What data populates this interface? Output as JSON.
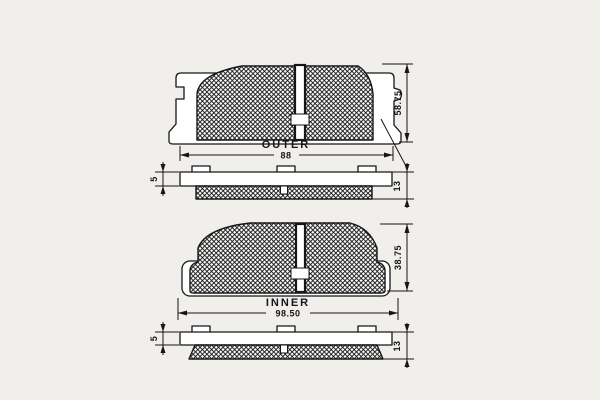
{
  "colors": {
    "paper": "#f1efec",
    "line": "#161616"
  },
  "outer_view": {
    "label": "OUTER",
    "width_dim": "88",
    "height_dim": "58.75"
  },
  "outer_profile": {
    "backplate_dim": "5",
    "thickness_dim": "13"
  },
  "inner_view": {
    "label": "INNER",
    "width_dim": "98.50",
    "height_dim": "38.75"
  },
  "inner_profile": {
    "backplate_dim": "5",
    "thickness_dim": "13"
  }
}
